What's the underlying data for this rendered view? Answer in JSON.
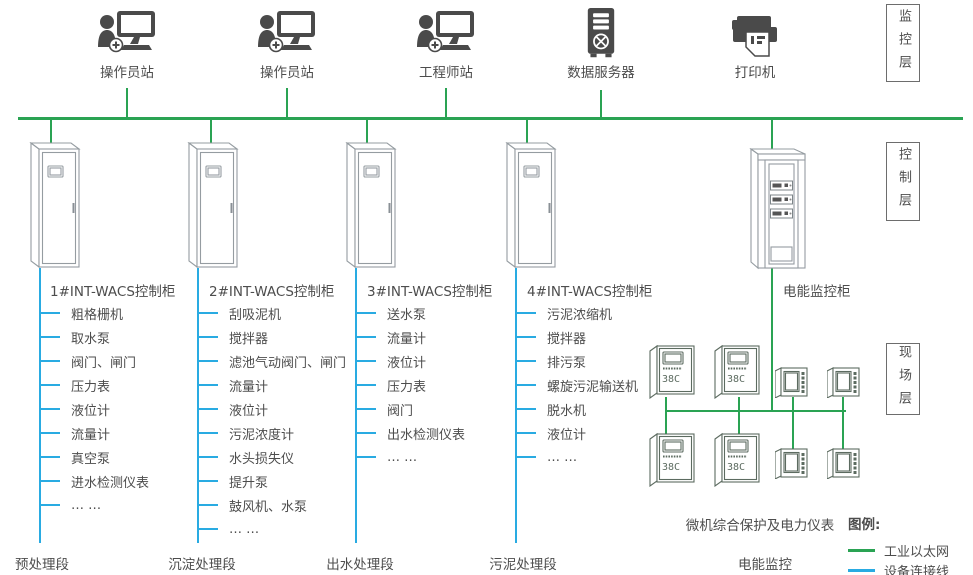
{
  "colors": {
    "ethernet_green": "#2aa353",
    "device_line_blue": "#29abe2",
    "icon_dark_gray": "#4a4a4a",
    "text_gray": "#4d4d4d"
  },
  "icons": {
    "operator-station-icon": "person+monitor silhouette",
    "engineer-station-icon": "person+monitor silhouette",
    "data-server-icon": "server tower with fan",
    "printer-icon": "printer with paper sheet",
    "control-cabinet-icon": "outlined 3d cabinet with door window",
    "power-cabinet-icon": "outlined 3d cabinet with 3 meter modules",
    "relay-meter-icon": "protection relay with display and digits",
    "panel-meter-icon": "small panel meter with side buttons"
  },
  "layers": [
    {
      "label": "监控层"
    },
    {
      "label": "控制层"
    },
    {
      "label": "现场层"
    }
  ],
  "top_stations": [
    {
      "label": "操作员站"
    },
    {
      "label": "操作员站"
    },
    {
      "label": "工程师站"
    },
    {
      "label": "数据服务器"
    },
    {
      "label": "打印机"
    }
  ],
  "cabinets": [
    {
      "title": "1#INT-WACS控制柜",
      "stage": "预处理段",
      "devices": [
        "粗格栅机",
        "取水泵",
        "阀门、闸门",
        "压力表",
        "液位计",
        "流量计",
        "真空泵",
        "进水检测仪表",
        "… …"
      ]
    },
    {
      "title": "2#INT-WACS控制柜",
      "stage": "沉淀处理段",
      "devices": [
        "刮吸泥机",
        "搅拌器",
        "滤池气动阀门、闸门",
        "流量计",
        "液位计",
        "污泥浓度计",
        "水头损失仪",
        "提升泵",
        "鼓风机、水泵",
        "… …"
      ]
    },
    {
      "title": "3#INT-WACS控制柜",
      "stage": "出水处理段",
      "devices": [
        "送水泵",
        "流量计",
        "液位计",
        "压力表",
        "阀门",
        "出水检测仪表",
        "… …"
      ]
    },
    {
      "title": "4#INT-WACS控制柜",
      "stage": "污泥处理段",
      "devices": [
        "污泥浓缩机",
        "搅拌器",
        "排污泵",
        "螺旋污泥输送机",
        "脱水机",
        "液位计",
        "… …"
      ]
    }
  ],
  "power": {
    "cabinet_title": "电能监控柜",
    "meters_label": "微机综合保护及电力仪表",
    "stage": "电能监控"
  },
  "legend": {
    "title": "图例:",
    "items": [
      {
        "label": "工业以太网",
        "color": "#2aa353"
      },
      {
        "label": "设备连接线",
        "color": "#29abe2"
      }
    ]
  }
}
